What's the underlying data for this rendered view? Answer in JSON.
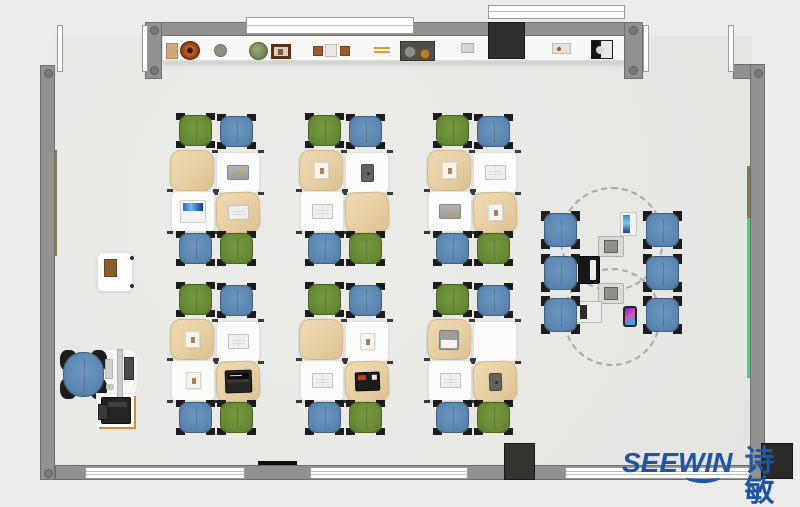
{
  "meta": {
    "scene": "top-down classroom floor plan render",
    "furniture_summary": {
      "student_clusters": 6,
      "desks_per_cluster": 4,
      "chairs_per_cluster": 4,
      "lounge_chairs": 6,
      "teacher_stations": 1
    }
  },
  "logo": {
    "brand": "SEEWIN",
    "cjk": "诗敏",
    "color": "#1d55a8"
  },
  "palette": {
    "outside": "#ececea",
    "floor": "#e9e9e6",
    "wall": "#919190",
    "wall_edge": "#6f6f6d",
    "window": "#fdfdfc",
    "chair_green": "#6a8c36",
    "chair_blue": "#5d89b4",
    "desk_white": "#fbfbf9",
    "desk_tan": "#e7cfa4",
    "board_green": "#2be07a",
    "board_brown": "#8a7950",
    "pillar_black": "#2e2e2c",
    "logo_blue": "#1d55a8"
  },
  "room": {
    "shelf_items": [
      {
        "name": "storage-box",
        "type": "box-tan",
        "x": 166,
        "y": 43
      },
      {
        "name": "clay-pot",
        "type": "pot-rings",
        "x": 180,
        "y": 41
      },
      {
        "name": "plate",
        "type": "plate-gray",
        "x": 214,
        "y": 44
      },
      {
        "name": "potted-plant",
        "type": "plant-green",
        "x": 249,
        "y": 42
      },
      {
        "name": "picture-frame",
        "type": "frame-art",
        "x": 271,
        "y": 44
      },
      {
        "name": "jar-small",
        "type": "jar-brown",
        "x": 313,
        "y": 46
      },
      {
        "name": "jar-large",
        "type": "jar-white",
        "x": 325,
        "y": 44
      },
      {
        "name": "jar-small-2",
        "type": "jar-brown",
        "x": 340,
        "y": 46
      },
      {
        "name": "orange-sticks",
        "type": "sticks-orange",
        "x": 374,
        "y": 47
      },
      {
        "name": "parts-tray",
        "type": "tray-parts",
        "x": 400,
        "y": 41
      },
      {
        "name": "small-tray",
        "type": "tray-small",
        "x": 461,
        "y": 43
      },
      {
        "name": "desk-tray",
        "type": "tray-mid",
        "x": 552,
        "y": 43
      },
      {
        "name": "mini-appliance",
        "type": "appliance-bw",
        "x": 591,
        "y": 40
      }
    ],
    "clusters": [
      {
        "id": 1,
        "x": 170,
        "y": 114,
        "items": {
          "tl": null,
          "tr": "laptop-gray",
          "bl": "laptop-open-blue",
          "br": "book-open"
        }
      },
      {
        "id": 2,
        "x": 299,
        "y": 114,
        "items": {
          "tl": "paper",
          "tr": "tablet-dark",
          "bl": "book-open",
          "br": null
        }
      },
      {
        "id": 3,
        "x": 427,
        "y": 114,
        "items": {
          "tl": "paper",
          "tr": "book-open",
          "bl": "laptop-gray",
          "br": "paper"
        }
      },
      {
        "id": 4,
        "x": 170,
        "y": 283,
        "items": {
          "tl": "paper",
          "tr": "book-open",
          "bl": "paper",
          "br": "laptop-open-dark"
        }
      },
      {
        "id": 5,
        "x": 299,
        "y": 283,
        "items": {
          "tl": null,
          "tr": "paper",
          "bl": "book-open",
          "br": "laptop-dark"
        }
      },
      {
        "id": 6,
        "x": 427,
        "y": 283,
        "items": {
          "tl": "laptop-open-white",
          "tr": null,
          "bl": "book-open",
          "br": "tablet-dark"
        }
      }
    ],
    "cluster_pattern": {
      "chair_colors": {
        "tl": "green",
        "tr": "blue",
        "bl": "blue",
        "br": "green"
      },
      "desk_tops": {
        "tl": "tan",
        "tr": "white",
        "bl": "white",
        "br": "tan"
      }
    },
    "lounge": {
      "chair_cols": [
        544,
        646
      ],
      "chair_rows": [
        213,
        256,
        298
      ],
      "dashed_tables": [
        {
          "x": 560,
          "y": 187,
          "d": 104
        },
        {
          "x": 563,
          "y": 268,
          "d": 98
        }
      ],
      "devices": [
        {
          "name": "tablet",
          "type": "tablet-blue",
          "x": 620,
          "y": 212
        },
        {
          "name": "device-case",
          "type": "case-gray",
          "x": 598,
          "y": 236
        },
        {
          "name": "laptop",
          "type": "laptop-black",
          "x": 578,
          "y": 256
        },
        {
          "name": "device-case-2",
          "type": "case-gray",
          "x": 598,
          "y": 283
        },
        {
          "name": "laptop-2",
          "type": "laptop-white",
          "x": 576,
          "y": 301
        },
        {
          "name": "smartphone",
          "type": "phone-gradient",
          "x": 623,
          "y": 306
        }
      ]
    }
  }
}
